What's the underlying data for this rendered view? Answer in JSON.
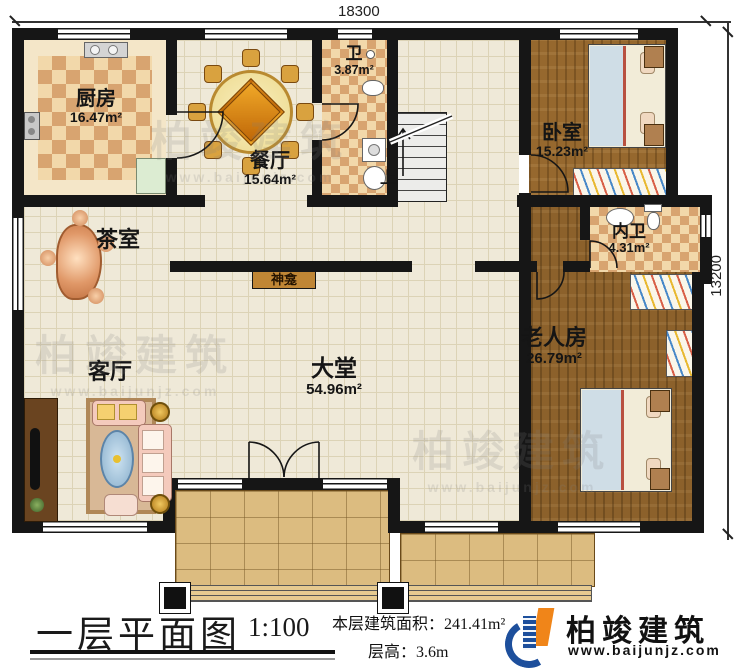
{
  "dimensions": {
    "top": "18300",
    "right": "13200"
  },
  "rooms": {
    "kitchen": {
      "name": "厨房",
      "area": "16.47m²"
    },
    "dining": {
      "name": "餐厅",
      "area": "15.64m²"
    },
    "bath": {
      "name": "卫",
      "area": "3.87m²"
    },
    "bedroom": {
      "name": "卧室",
      "area": "15.23m²"
    },
    "tea_room": {
      "name": "茶室"
    },
    "shrine": {
      "name": "神龛"
    },
    "ensuite": {
      "name": "内卫",
      "area": "4.31m²"
    },
    "living_room": {
      "name": "客厅"
    },
    "main_hall": {
      "name": "大堂",
      "area": "54.96m²"
    },
    "elder_room": {
      "name": "老人房",
      "area": "26.79m²"
    },
    "stairs": {
      "label": "上"
    }
  },
  "title_block": {
    "title": "一层平面图",
    "scale": "1:100",
    "area_label": "本层建筑面积：",
    "area_value": "241.41m²",
    "height_label": "层高：",
    "height_value": "3.6m"
  },
  "branding": {
    "company": "柏竣建筑",
    "website": "www.baijunjz.com"
  },
  "watermark": {
    "text": "柏竣建筑",
    "url": "www.baijunjz.com"
  },
  "colors": {
    "wall": "#161616",
    "floor_tile": "#efe9d8",
    "checker_dark": "#d8a470",
    "wood": "#96682e",
    "porch": "#dcbc80",
    "brand_blue": "#1d4f9c",
    "brand_orange": "#f08519"
  }
}
